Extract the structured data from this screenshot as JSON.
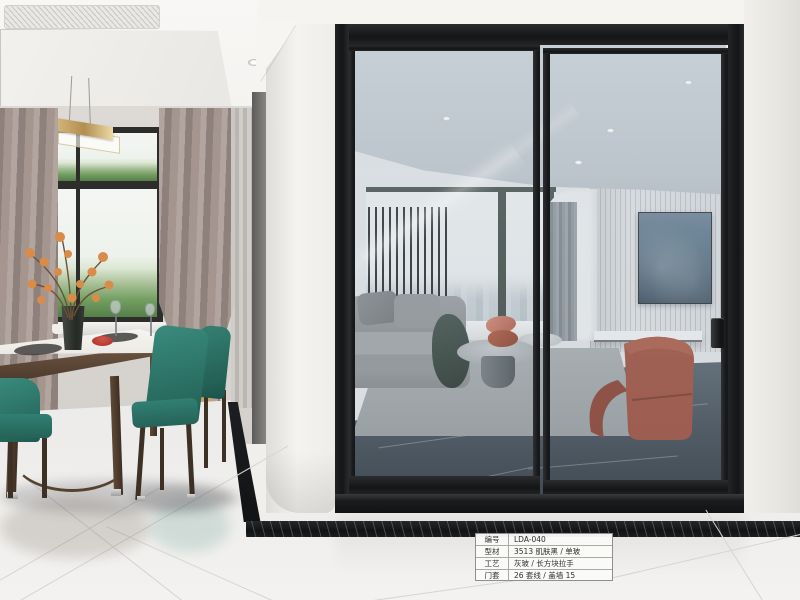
{
  "spec_card": {
    "rows": [
      {
        "label": "编号",
        "value": "LDA-040"
      },
      {
        "label": "型材",
        "value": "3513 肌肤黑 / 单玻"
      },
      {
        "label": "工艺",
        "value": "灰玻 / 长方块拉手"
      },
      {
        "label": "门套",
        "value": "26 套线 / 盖墙 15"
      }
    ]
  },
  "colors": {
    "door_frame_black": "#17181a",
    "glass_tint": "#b9c4ce",
    "dining_chair_teal": "#2e7b6f",
    "armchair_terracotta": "#9e5545",
    "curtain_taupe": "#a3958f",
    "interior_marble_floor": "#49545e",
    "exterior_tile_white": "#f0efed",
    "marble_inlay_black": "#121315",
    "pendant_gold": "#c9a96a",
    "tv_screen_blue": "#43596b",
    "throw_green": "#36443e"
  }
}
